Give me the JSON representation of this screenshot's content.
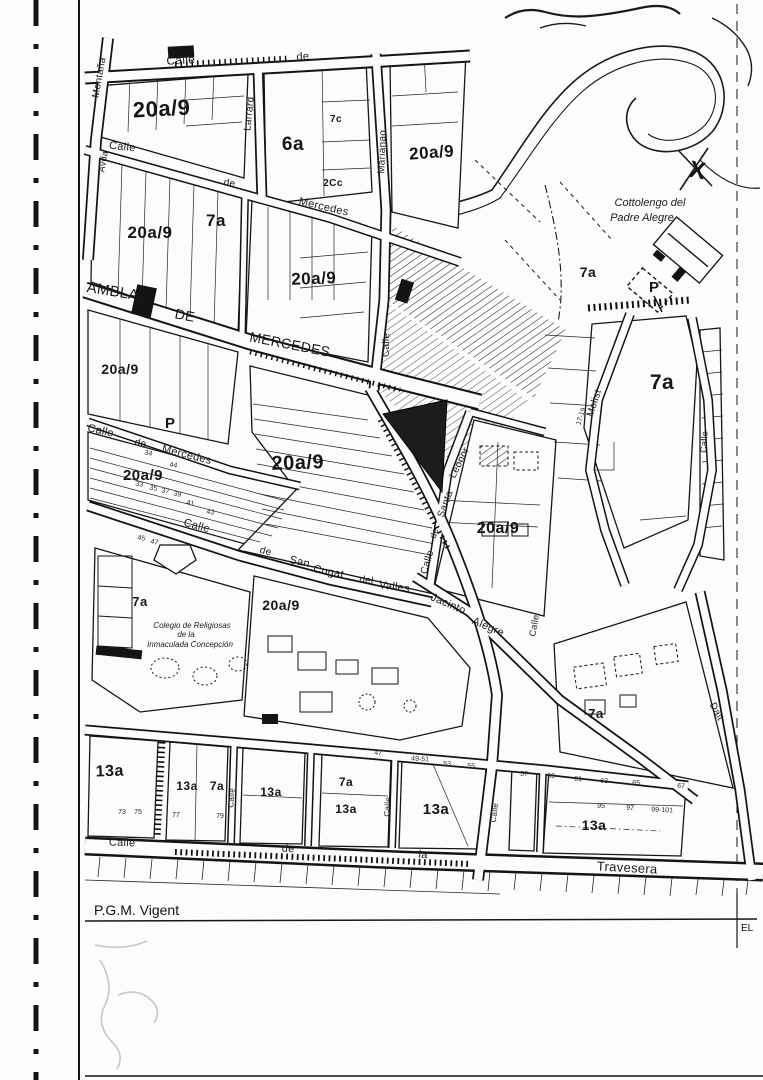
{
  "page": {
    "footer_title": "P.G.M. Vigent",
    "corner_label": "EL"
  },
  "places": {
    "cottolengo_line1": "Cottolengo del",
    "cottolengo_line2": "Padre Alegre",
    "colegio_line1": "Colegio de Religiosas",
    "colegio_line2": "de la",
    "colegio_line3": "Inmaculada Concepción"
  },
  "zone_labels": [
    {
      "t": "20a/9",
      "x": 162,
      "y": 116,
      "s": 22,
      "r": -3
    },
    {
      "t": "6a",
      "x": 293,
      "y": 150,
      "s": 19
    },
    {
      "t": "7c",
      "x": 336,
      "y": 122,
      "s": 10
    },
    {
      "t": "2Cc",
      "x": 333,
      "y": 186,
      "s": 10
    },
    {
      "t": "20a/9",
      "x": 432,
      "y": 158,
      "s": 17,
      "r": -4
    },
    {
      "t": "7a",
      "x": 216,
      "y": 226,
      "s": 17
    },
    {
      "t": "20a/9",
      "x": 150,
      "y": 238,
      "s": 17
    },
    {
      "t": "20a/9",
      "x": 314,
      "y": 284,
      "s": 17,
      "r": -2
    },
    {
      "t": "7a",
      "x": 588,
      "y": 277,
      "s": 14
    },
    {
      "t": "7a",
      "x": 662,
      "y": 389,
      "s": 21
    },
    {
      "t": "20a/9",
      "x": 120,
      "y": 374,
      "s": 14
    },
    {
      "t": "20a/9",
      "x": 143,
      "y": 480,
      "s": 15
    },
    {
      "t": "20a/9",
      "x": 298,
      "y": 469,
      "s": 20,
      "r": -2
    },
    {
      "t": "20a/9",
      "x": 498,
      "y": 533,
      "s": 16
    },
    {
      "t": "7a",
      "x": 140,
      "y": 606,
      "s": 13
    },
    {
      "t": "20a/9",
      "x": 281,
      "y": 610,
      "s": 14
    },
    {
      "t": "7a",
      "x": 596,
      "y": 718,
      "s": 13
    },
    {
      "t": "13a",
      "x": 110,
      "y": 776,
      "s": 16,
      "r": -2
    },
    {
      "t": "13a",
      "x": 187,
      "y": 790,
      "s": 12
    },
    {
      "t": "7a",
      "x": 217,
      "y": 790,
      "s": 12
    },
    {
      "t": "13a",
      "x": 271,
      "y": 796,
      "s": 12
    },
    {
      "t": "7a",
      "x": 346,
      "y": 786,
      "s": 12
    },
    {
      "t": "13a",
      "x": 346,
      "y": 813,
      "s": 12
    },
    {
      "t": "13a",
      "x": 436,
      "y": 814,
      "s": 15
    },
    {
      "t": "13a",
      "x": 594,
      "y": 830,
      "s": 14
    }
  ],
  "street_labels": [
    {
      "t": "Calle",
      "x": 181,
      "y": 64,
      "s": 12,
      "r": -3,
      "ls": 1
    },
    {
      "t": "de",
      "x": 303,
      "y": 60,
      "s": 11,
      "r": -3
    },
    {
      "t": "Montaña",
      "x": 102,
      "y": 78,
      "s": 10,
      "r": -80
    },
    {
      "t": "Avda",
      "x": 106,
      "y": 162,
      "s": 9,
      "r": -80
    },
    {
      "t": "Larrard",
      "x": 252,
      "y": 114,
      "s": 10,
      "r": -84
    },
    {
      "t": "Marianao",
      "x": 385,
      "y": 152,
      "s": 10,
      "r": -88
    },
    {
      "t": "Calle",
      "x": 389,
      "y": 345,
      "s": 10,
      "r": -88
    },
    {
      "t": "Calle",
      "x": 122,
      "y": 150,
      "s": 11,
      "r": 6
    },
    {
      "t": "de",
      "x": 229,
      "y": 186,
      "s": 10,
      "r": 10
    },
    {
      "t": "Mercedes",
      "x": 323,
      "y": 210,
      "s": 11,
      "r": 13
    },
    {
      "t": "AMBLA",
      "x": 112,
      "y": 296,
      "s": 15,
      "r": 9,
      "ls": 2
    },
    {
      "t": "DE",
      "x": 184,
      "y": 320,
      "s": 14,
      "r": 11,
      "ls": 1
    },
    {
      "t": "MERCEDES",
      "x": 289,
      "y": 349,
      "s": 14,
      "r": 11,
      "ls": 3
    },
    {
      "t": "Calle",
      "x": 100,
      "y": 434,
      "s": 11,
      "r": 13
    },
    {
      "t": "de",
      "x": 140,
      "y": 446,
      "s": 10,
      "r": 13
    },
    {
      "t": "Mercedes",
      "x": 186,
      "y": 458,
      "s": 11,
      "r": 14
    },
    {
      "t": "Calle",
      "x": 196,
      "y": 529,
      "s": 11,
      "r": 15
    },
    {
      "t": "de",
      "x": 265,
      "y": 554,
      "s": 10,
      "r": 14
    },
    {
      "t": "San",
      "x": 299,
      "y": 565,
      "s": 11,
      "r": 13
    },
    {
      "t": "Cugat",
      "x": 328,
      "y": 575,
      "s": 11,
      "r": 11
    },
    {
      "t": "del",
      "x": 366,
      "y": 583,
      "s": 10,
      "r": 9
    },
    {
      "t": "Valles",
      "x": 394,
      "y": 590,
      "s": 11,
      "r": 8
    },
    {
      "t": "Calle",
      "x": 430,
      "y": 563,
      "s": 10,
      "r": -73
    },
    {
      "t": "de",
      "x": 437,
      "y": 534,
      "s": 9,
      "r": -72
    },
    {
      "t": "Santa",
      "x": 448,
      "y": 505,
      "s": 10,
      "r": -70
    },
    {
      "t": "Leonor",
      "x": 462,
      "y": 464,
      "s": 10,
      "r": -64
    },
    {
      "t": "Jacinto",
      "x": 447,
      "y": 607,
      "s": 11,
      "r": 23
    },
    {
      "t": "Alegre",
      "x": 487,
      "y": 630,
      "s": 11,
      "r": 23
    },
    {
      "t": "Calle",
      "x": 537,
      "y": 626,
      "s": 9,
      "r": -80
    },
    {
      "t": "Molist",
      "x": 597,
      "y": 404,
      "s": 10,
      "r": -72
    },
    {
      "t": "Calle",
      "x": 707,
      "y": 442,
      "s": 9,
      "r": -86
    },
    {
      "t": "Dalt",
      "x": 714,
      "y": 713,
      "s": 10,
      "r": 62
    },
    {
      "t": "Calle",
      "x": 122,
      "y": 846,
      "s": 11,
      "r": 2
    },
    {
      "t": "de",
      "x": 288,
      "y": 852,
      "s": 11,
      "r": 3
    },
    {
      "t": "la",
      "x": 423,
      "y": 858,
      "s": 11,
      "r": 3
    },
    {
      "t": "Travesera",
      "x": 627,
      "y": 872,
      "s": 13,
      "r": 3,
      "ls": 2
    },
    {
      "t": "Calle",
      "x": 234,
      "y": 798,
      "s": 8,
      "r": -86
    },
    {
      "t": "Calle",
      "x": 390,
      "y": 807,
      "s": 8,
      "r": -86
    },
    {
      "t": "Calle",
      "x": 497,
      "y": 813,
      "s": 8,
      "r": -82
    }
  ],
  "markers": [
    {
      "t": "P",
      "x": 170,
      "y": 428,
      "s": 15
    },
    {
      "t": "P",
      "x": 654,
      "y": 292,
      "s": 15
    },
    {
      "t": "X",
      "x": 696,
      "y": 178,
      "s": 24,
      "r": 10
    }
  ],
  "plot_numbers": [
    {
      "t": "34",
      "x": 148,
      "y": 455,
      "s": 7,
      "r": 12
    },
    {
      "t": "44",
      "x": 173,
      "y": 467,
      "s": 7,
      "r": 12
    },
    {
      "t": "33",
      "x": 139,
      "y": 486,
      "s": 7,
      "r": 12
    },
    {
      "t": "35",
      "x": 153,
      "y": 490,
      "s": 7,
      "r": 12
    },
    {
      "t": "37",
      "x": 165,
      "y": 493,
      "s": 7,
      "r": 12
    },
    {
      "t": "39",
      "x": 177,
      "y": 496,
      "s": 7,
      "r": 12
    },
    {
      "t": "41",
      "x": 190,
      "y": 505,
      "s": 7,
      "r": 12
    },
    {
      "t": "43",
      "x": 210,
      "y": 514,
      "s": 7,
      "r": 12
    },
    {
      "t": "45",
      "x": 141,
      "y": 540,
      "s": 7,
      "r": 12
    },
    {
      "t": "47",
      "x": 154,
      "y": 544,
      "s": 7,
      "r": 12
    },
    {
      "t": "17-19",
      "x": 583,
      "y": 417,
      "s": 7,
      "r": -72
    },
    {
      "t": "47",
      "x": 378,
      "y": 755,
      "s": 7,
      "r": 3
    },
    {
      "t": "49-51",
      "x": 420,
      "y": 761,
      "s": 7,
      "r": 3
    },
    {
      "t": "53",
      "x": 447,
      "y": 766,
      "s": 7,
      "r": 3
    },
    {
      "t": "55",
      "x": 471,
      "y": 768,
      "s": 7,
      "r": 3
    },
    {
      "t": "57",
      "x": 524,
      "y": 776,
      "s": 7,
      "r": 3
    },
    {
      "t": "59",
      "x": 551,
      "y": 778,
      "s": 7,
      "r": 3
    },
    {
      "t": "61",
      "x": 578,
      "y": 781,
      "s": 7,
      "r": 3
    },
    {
      "t": "63",
      "x": 604,
      "y": 783,
      "s": 7,
      "r": 3
    },
    {
      "t": "65",
      "x": 636,
      "y": 785,
      "s": 7,
      "r": 3
    },
    {
      "t": "67",
      "x": 681,
      "y": 788,
      "s": 7,
      "r": 3
    },
    {
      "t": "73",
      "x": 122,
      "y": 814,
      "s": 7
    },
    {
      "t": "75",
      "x": 138,
      "y": 814,
      "s": 7
    },
    {
      "t": "77",
      "x": 176,
      "y": 817,
      "s": 7
    },
    {
      "t": "79",
      "x": 220,
      "y": 818,
      "s": 7
    },
    {
      "t": "95",
      "x": 601,
      "y": 808,
      "s": 7,
      "r": 3
    },
    {
      "t": "97",
      "x": 630,
      "y": 810,
      "s": 7,
      "r": 3
    },
    {
      "t": "99-101",
      "x": 662,
      "y": 812,
      "s": 7,
      "r": 3
    }
  ]
}
